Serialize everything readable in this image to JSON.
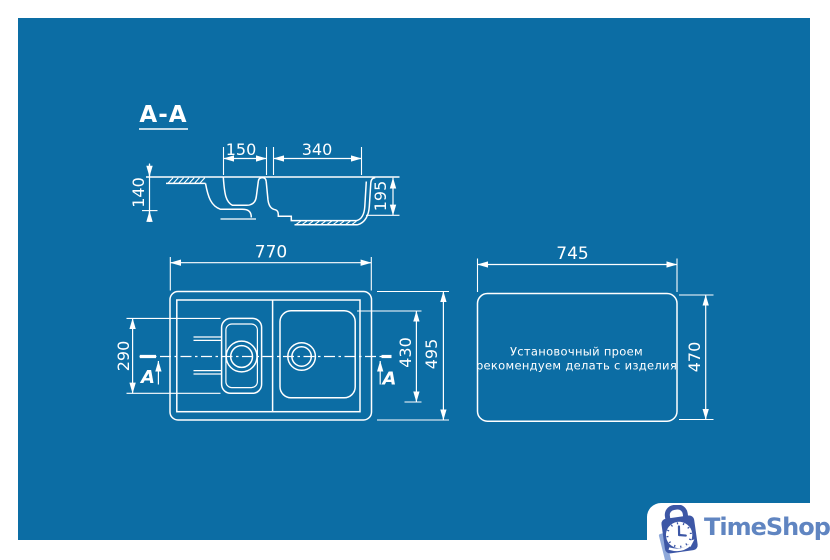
{
  "colors": {
    "background": "#ffffff",
    "canvas": "#0c6da4",
    "line": "#ffffff",
    "logo_bag": "#3d57a6",
    "logo_stripe": "#8fa9da",
    "logo_text_color": "#6085c1"
  },
  "section_view": {
    "title": "A-A",
    "dim_small_bowl_width": "150",
    "dim_large_bowl_width": "340",
    "dim_total_depth": "140",
    "dim_bowl_depth": "195"
  },
  "plan_view": {
    "dim_overall_width": "770",
    "dim_small_bowl_length": "290",
    "dim_large_bowl_length": "430",
    "dim_overall_depth": "495",
    "section_label": "A"
  },
  "cutout_view": {
    "dim_cutout_width": "745",
    "dim_cutout_height": "470",
    "note_line1": "Установочный проем",
    "note_line2": "рекомендуем делать с изделия"
  },
  "branding": {
    "logo_text": "TimeShop"
  }
}
